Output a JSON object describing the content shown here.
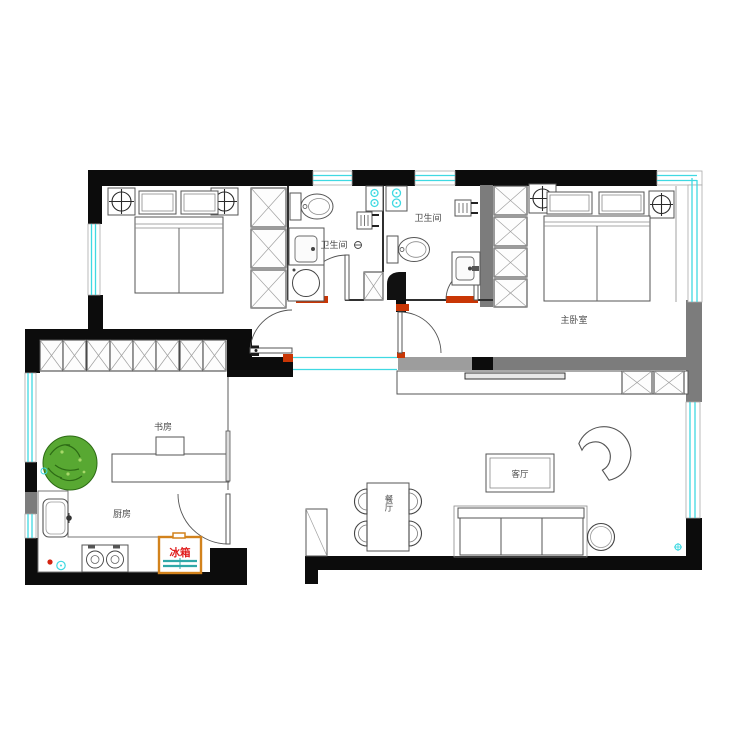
{
  "title": "apartment-floor-plan",
  "rooms": {
    "master_bedroom": {
      "label": "主卧室"
    },
    "bathroom_left": {
      "label": "卫生间"
    },
    "bathroom_right": {
      "label": "卫生间"
    },
    "kitchen": {
      "label": "厨房"
    },
    "study": {
      "label": "书房"
    },
    "dining": {
      "label": "餐厅"
    },
    "living": {
      "label": "客厅"
    }
  },
  "appliances": {
    "fridge": {
      "label": "冰箱"
    }
  },
  "colors": {
    "wall_black": "#0c0c0c",
    "wall_gray": "#7c7c7c",
    "window_cyan": "#3fd9e2",
    "threshold_red": "#c93605",
    "fridge_border_orange": "#d2821c",
    "fridge_text_red": "#e01d1d",
    "fridge_shelf_teal": "#2fa8a8",
    "plant_green": "#58a832",
    "line_gray": "#555555"
  }
}
